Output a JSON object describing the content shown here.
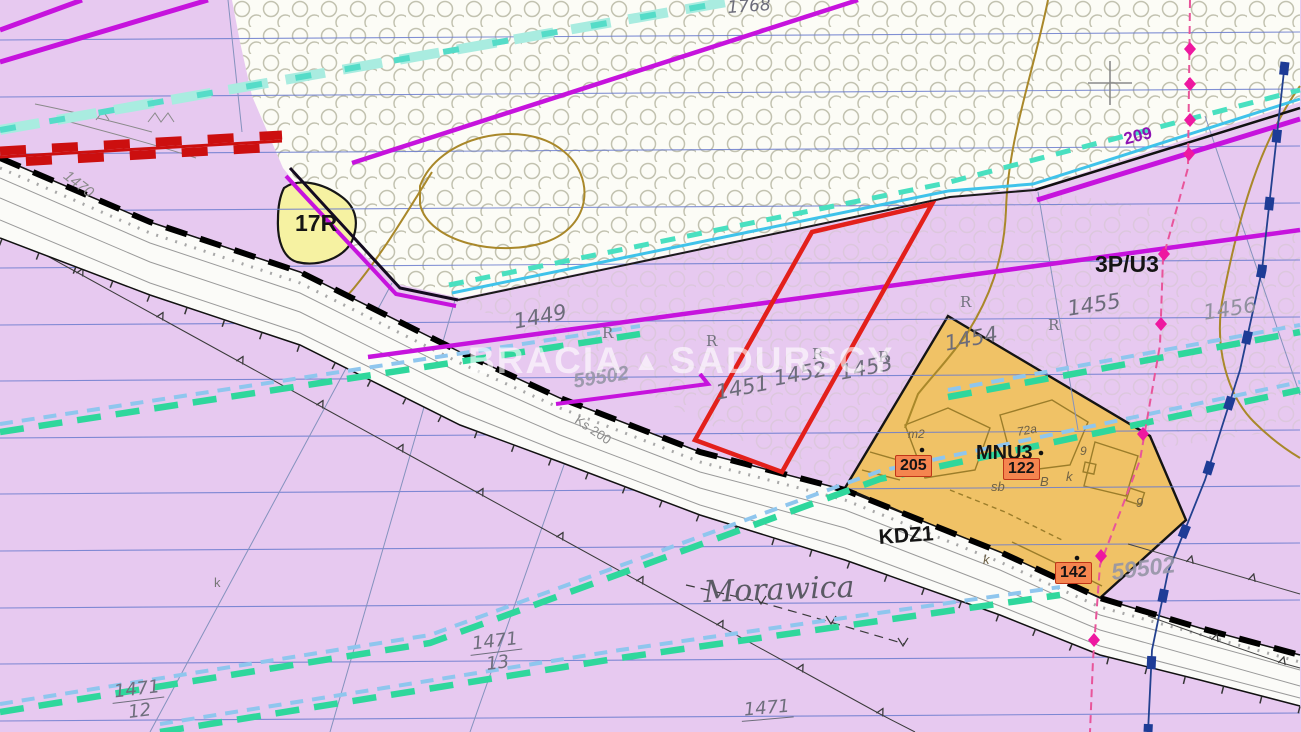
{
  "map": {
    "type": "zoning-plan-map",
    "watermark": {
      "wm1": "BRACIA",
      "wm_logo": "▲",
      "wm2": "SADURSCY"
    },
    "labels": {
      "top_parcel": "1768",
      "boundary_no": "209",
      "zone_r": "17R",
      "zone_pu": "3P/U3",
      "zone_mnu": "MNU3",
      "road": "KDZ1",
      "place": "Morawica",
      "p1449": "1449",
      "p1451": "1451",
      "p1452": "1452",
      "p1453": "1453",
      "p1454": "1454",
      "p1455": "1455",
      "p1456": "1456",
      "survey1": "59502",
      "survey2": "59502",
      "addr1": "205",
      "addr2": "122",
      "addr3": "142",
      "f_num": "1471",
      "f_den_a": "13",
      "f_den_b": "12",
      "r": "R",
      "k": "k",
      "sb": "sb",
      "m2": "m2",
      "b": "B",
      "n9": "9",
      "n72": "72a",
      "road_note": "Ks 200",
      "road_note2": "1470"
    },
    "colors": {
      "base_zone": "#e7c9f0",
      "residential_zone": "#f0c266",
      "agri_zone": "#f6f2a2",
      "highlight_parcel": "#e3201b",
      "plan_boundary_red": "#cc0f0f",
      "boundary_magenta": "#c613dd",
      "utility_green": "#2fd79c",
      "utility_teal": "#49e0c0",
      "utility_cyan": "#3fc3ea",
      "gas_navy": "#1e3c96",
      "marker_pink": "#ee18a0",
      "grid_blue": "#6b7cce"
    }
  }
}
